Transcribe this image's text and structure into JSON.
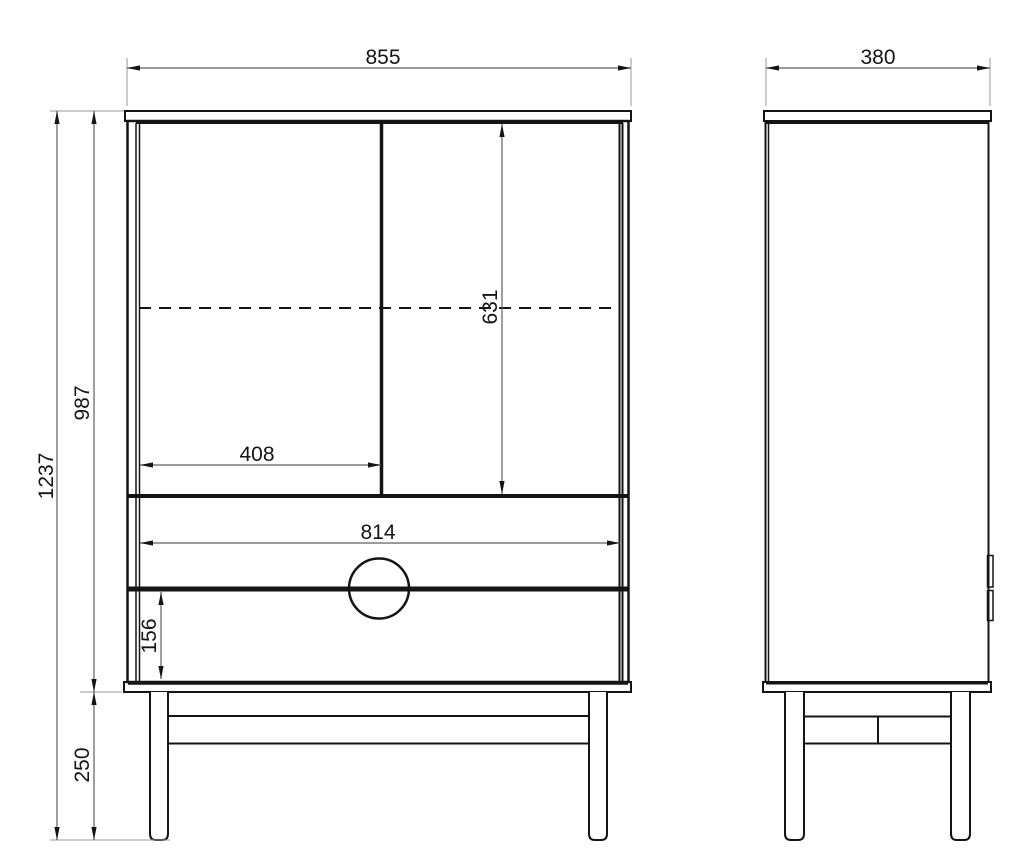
{
  "dimensions": {
    "overall_width": "855",
    "overall_depth": "380",
    "overall_height": "1237",
    "carcass_height": "987",
    "door_opening_height": "631",
    "left_door_width": "408",
    "drawer_width": "814",
    "bottom_drawer_height": "156",
    "leg_height": "250"
  },
  "style": {
    "background": "#ffffff",
    "object_line_color": "#141414",
    "dimension_line_color": "#5f5f5f",
    "extension_line_color": "#9a9a9a",
    "label_color": "#141414"
  }
}
